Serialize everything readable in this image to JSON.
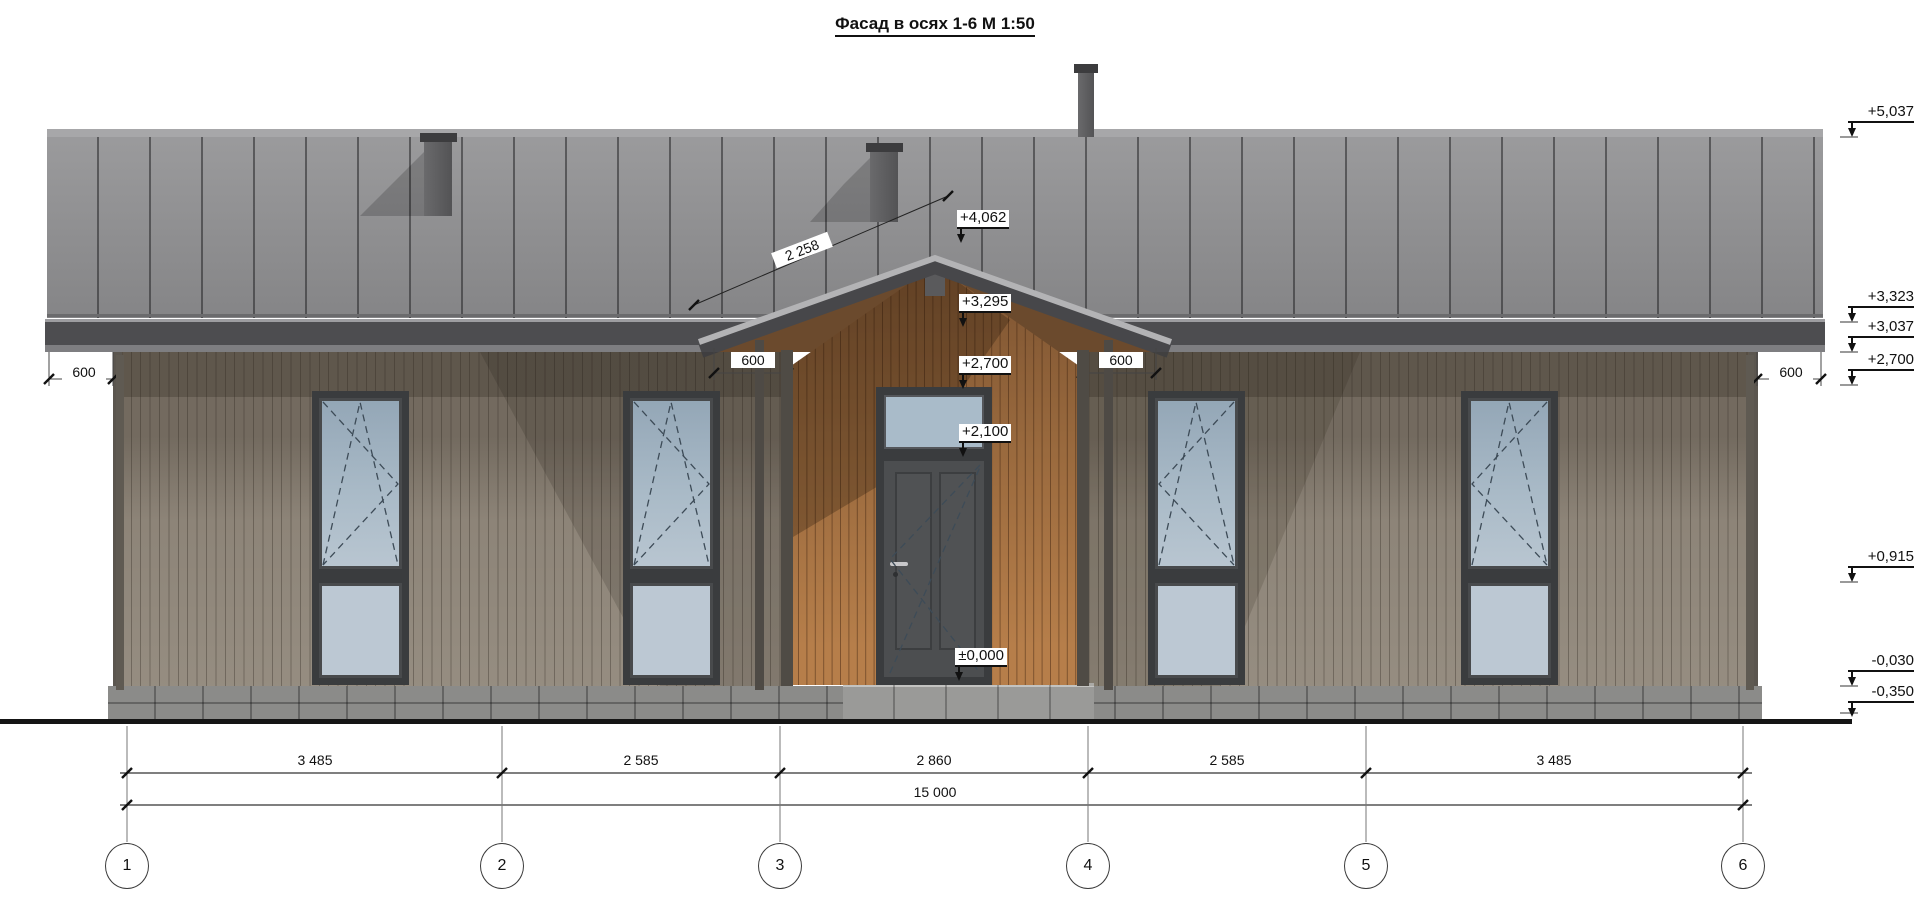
{
  "title": "Фасад в осях 1-6  М 1:50",
  "right_elevation_marks": [
    {
      "label": "+5,037"
    },
    {
      "label": "+3,323"
    },
    {
      "label": "+3,037"
    },
    {
      "label": "+2,700"
    },
    {
      "label": "+0,915"
    },
    {
      "label": "-0,030"
    },
    {
      "label": "-0,350"
    }
  ],
  "center_elevation_marks": [
    {
      "label": "+4,062"
    },
    {
      "label": "+3,295"
    },
    {
      "label": "+2,700"
    },
    {
      "label": "+2,100"
    },
    {
      "label": "±0,000"
    }
  ],
  "overhang_dims": [
    {
      "label": "600"
    },
    {
      "label": "600"
    },
    {
      "label": "600"
    },
    {
      "label": "600"
    }
  ],
  "slope_dim": {
    "label": "2 258"
  },
  "bottom_dims": {
    "segments": [
      {
        "label": "3 485"
      },
      {
        "label": "2 585"
      },
      {
        "label": "2 860"
      },
      {
        "label": "2 585"
      },
      {
        "label": "3 485"
      }
    ],
    "total": {
      "label": "15 000"
    }
  },
  "axes": [
    {
      "label": "1"
    },
    {
      "label": "2"
    },
    {
      "label": "3"
    },
    {
      "label": "4"
    },
    {
      "label": "5"
    },
    {
      "label": "6"
    }
  ],
  "colors": {
    "roof": "#8f8f91",
    "fascia": "#4d4d50",
    "wall": "#877e72",
    "wood_cladding": "#9a6a3e",
    "glass": "#a9bac7",
    "ground_line": "#151515"
  }
}
